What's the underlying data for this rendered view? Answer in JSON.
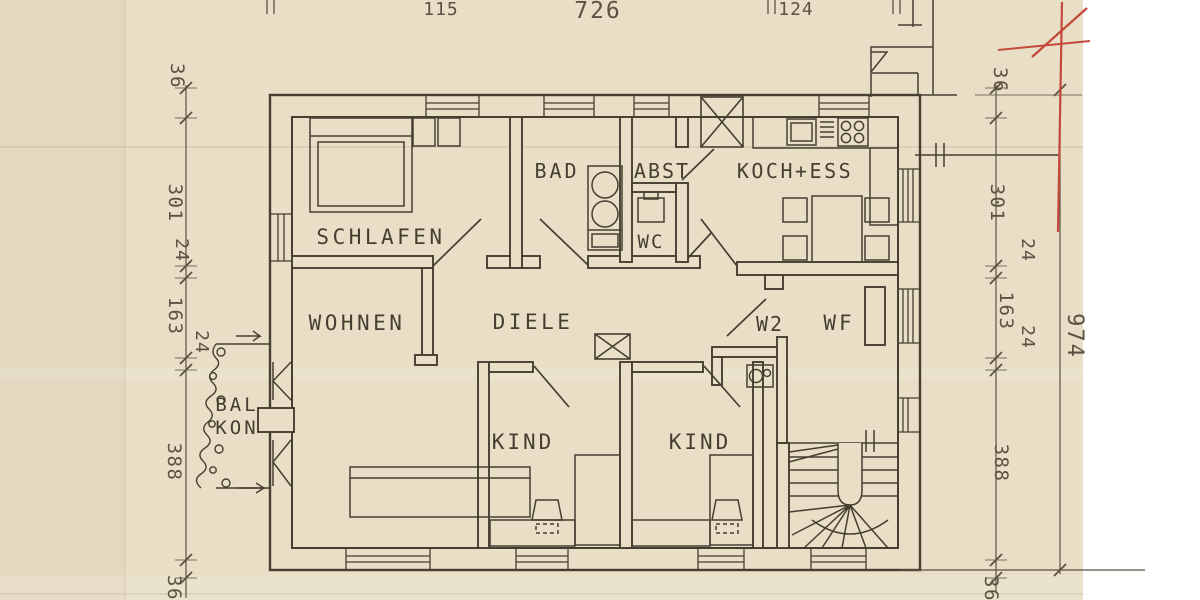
{
  "colors": {
    "paper": "#e8dfc6",
    "margin": "#ffffff",
    "ink": "#463e31",
    "dim": "#5b5244",
    "red": "#c5483a"
  },
  "labels": {
    "schlafen": "SCHLAFEN",
    "bad": "BAD",
    "abst": "ABST",
    "wc": "WC",
    "koch_ess": "KOCH+ESS",
    "wohnen": "WOHNEN",
    "diele": "DIELE",
    "w2": "W2",
    "wf": "WF",
    "kind_left": "KIND",
    "kind_right": "KIND",
    "balkon_top": "BAL",
    "balkon_bottom": "KON"
  },
  "dimensions": {
    "top": {
      "t115": "115",
      "t726": "726",
      "t124": "124"
    },
    "left": {
      "l36a": "36",
      "l301": "301",
      "l24a": "24",
      "l163": "163",
      "l24b": "24",
      "l388": "388",
      "l36b": "36"
    },
    "right": {
      "r36a": "36",
      "r301": "301",
      "r24a": "24",
      "r163": "163",
      "r24b": "24",
      "r388": "388",
      "r36b": "36"
    },
    "overall": "974"
  }
}
